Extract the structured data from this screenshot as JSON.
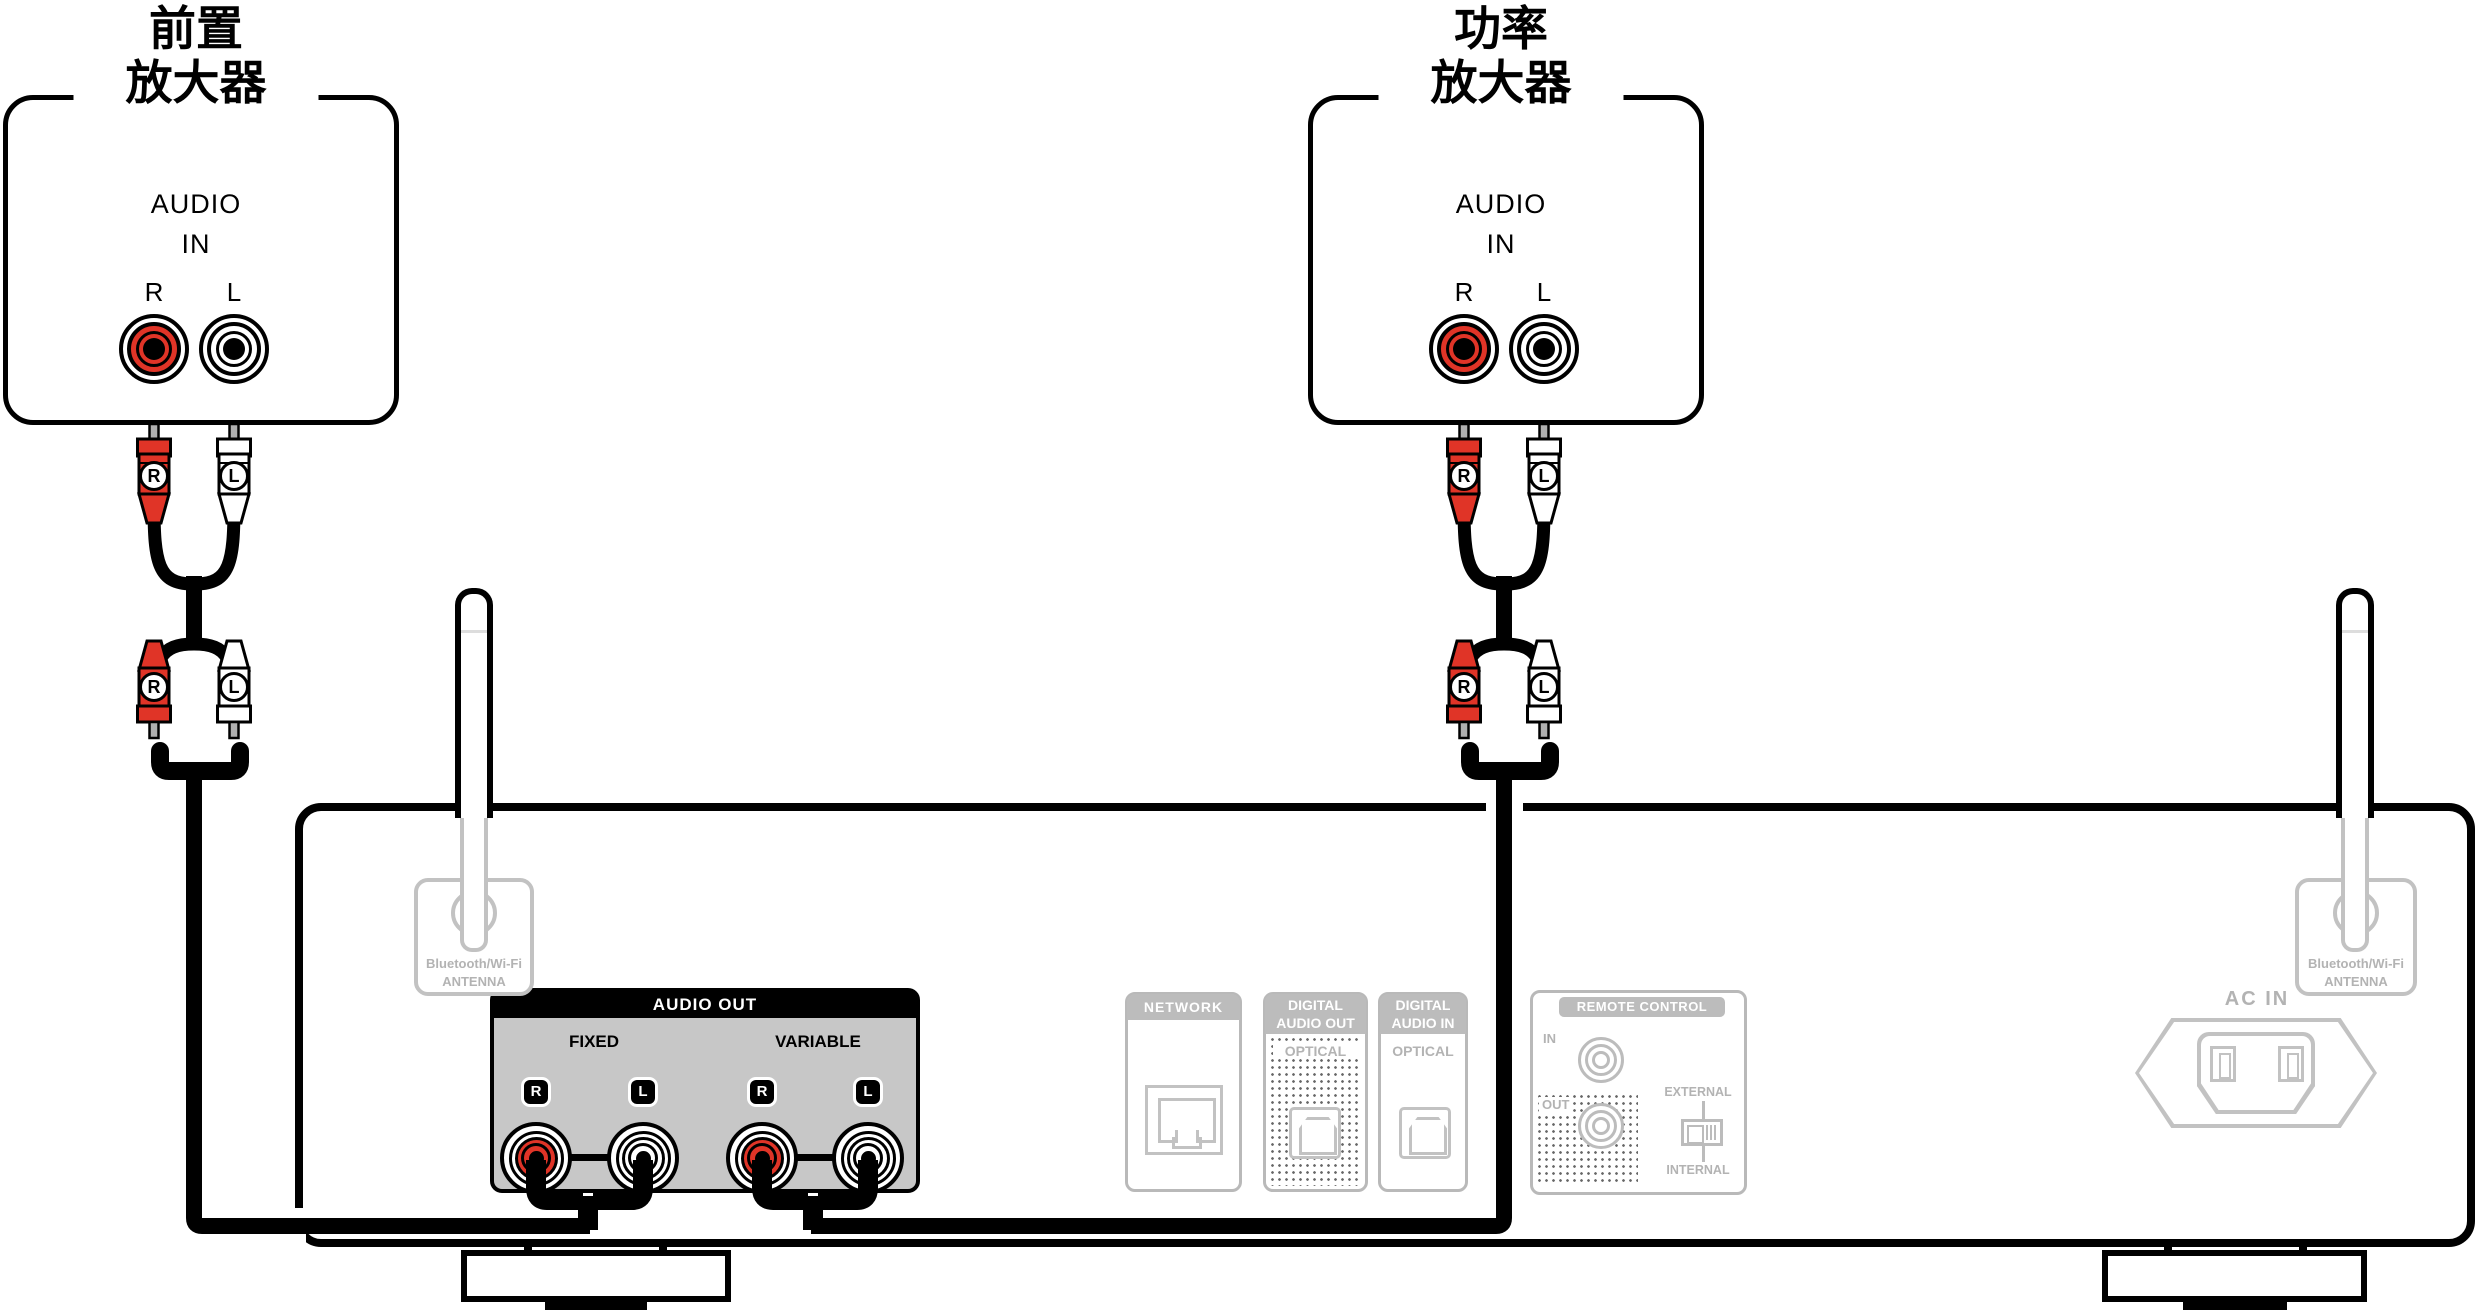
{
  "amplifiers": [
    {
      "title_line1": "前置",
      "title_line2": "放大器",
      "audio": "AUDIO",
      "in": "IN",
      "right": "R",
      "left": "L"
    },
    {
      "title_line1": "功率",
      "title_line2": "放大器",
      "audio": "AUDIO",
      "in": "IN",
      "right": "R",
      "left": "L"
    }
  ],
  "cable": {
    "right": "R",
    "left": "L"
  },
  "rear": {
    "antenna_left": {
      "line1": "Bluetooth/Wi-Fi",
      "line2": "ANTENNA"
    },
    "antenna_right": {
      "line1": "Bluetooth/Wi-Fi",
      "line2": "ANTENNA"
    },
    "audio_out": {
      "title": "AUDIO OUT",
      "fixed": "FIXED",
      "variable": "VARIABLE",
      "r": "R",
      "l": "L"
    },
    "network": {
      "title": "NETWORK"
    },
    "digital_out": {
      "title_line1": "DIGITAL",
      "title_line2": "AUDIO OUT",
      "connector": "OPTICAL"
    },
    "digital_in": {
      "title_line1": "DIGITAL",
      "title_line2": "AUDIO IN",
      "connector": "OPTICAL"
    },
    "remote": {
      "title": "REMOTE CONTROL",
      "in": "IN",
      "out": "OUT",
      "external": "EXTERNAL",
      "internal": "INTERNAL"
    },
    "ac_in": {
      "title": "AC IN"
    }
  },
  "colors": {
    "red": "#e03427",
    "ghost": "#b3b3b3",
    "panel_gray": "#c7c7c7",
    "black": "#000000"
  }
}
